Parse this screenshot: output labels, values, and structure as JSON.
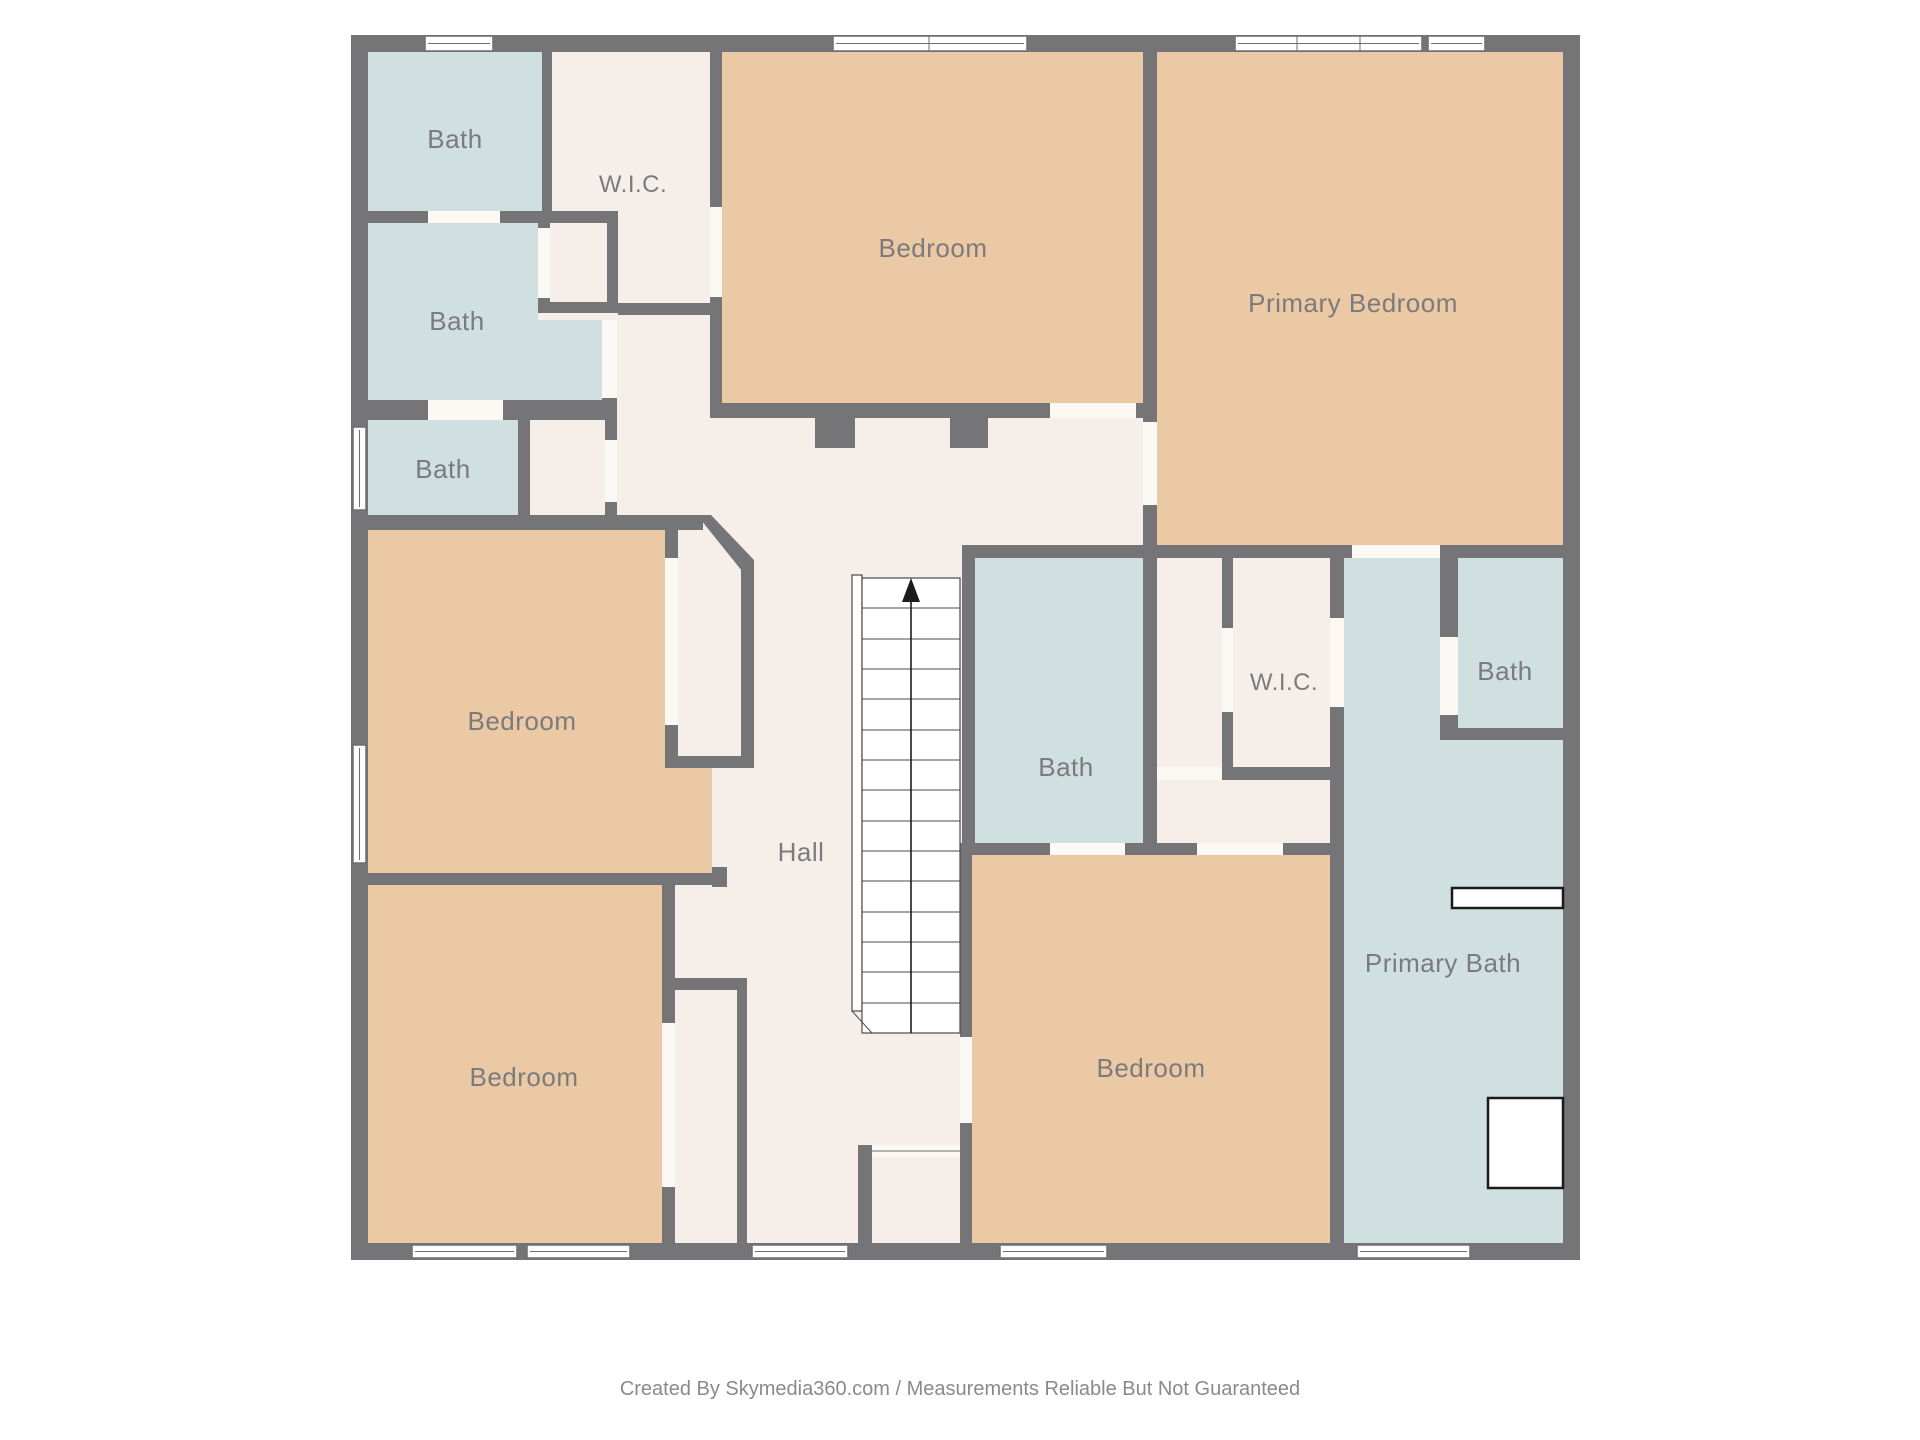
{
  "footer": {
    "credit": "Created By Skymedia360.com / Measurements Reliable But Not Guaranteed"
  },
  "colors": {
    "background": "#ffffff",
    "wall": "#757578",
    "bath_fill": "#d0e0e1",
    "bedroom_fill": "#ebc9a4",
    "hall_fill": "#f6eee8",
    "door_gap": "#fcf9f4",
    "window_fill": "#ffffff",
    "label_text": "#7b7b7d",
    "footer_text": "#8a8a8a"
  },
  "stairs": {
    "direction": "up"
  },
  "rooms": [
    {
      "id": "bath-top-left",
      "label": "Bath"
    },
    {
      "id": "wic-top-left",
      "label": "W.I.C."
    },
    {
      "id": "bath-left-middle",
      "label": "Bath"
    },
    {
      "id": "bath-left-lower",
      "label": "Bath"
    },
    {
      "id": "bedroom-top-center",
      "label": "Bedroom"
    },
    {
      "id": "primary-bedroom",
      "label": "Primary Bedroom"
    },
    {
      "id": "bedroom-middle-left",
      "label": "Bedroom"
    },
    {
      "id": "hall",
      "label": "Hall"
    },
    {
      "id": "bath-center",
      "label": "Bath"
    },
    {
      "id": "wic-right",
      "label": "W.I.C."
    },
    {
      "id": "bath-top-right",
      "label": "Bath"
    },
    {
      "id": "primary-bath",
      "label": "Primary Bath"
    },
    {
      "id": "bedroom-bottom-left",
      "label": "Bedroom"
    },
    {
      "id": "bedroom-bottom-center",
      "label": "Bedroom"
    }
  ]
}
